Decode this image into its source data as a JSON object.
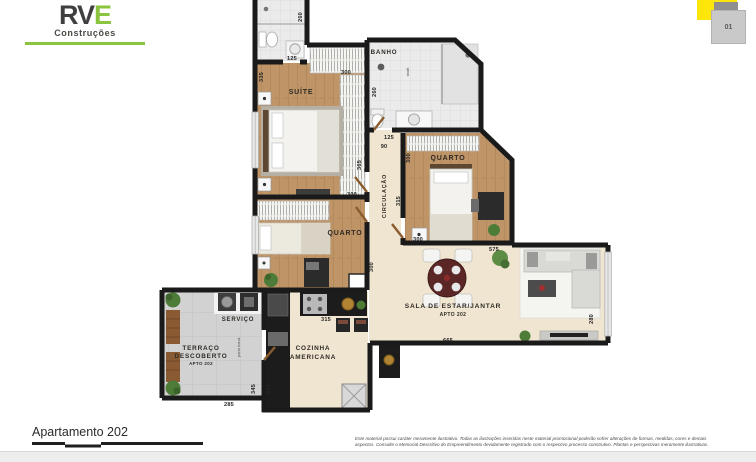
{
  "logo": {
    "brand_part1": "RV",
    "brand_part2": "E",
    "subtitle": "Construções"
  },
  "key_plan": {
    "unit_label": "01"
  },
  "rooms": {
    "banho": "BANHO",
    "suite": "SUÍTE",
    "quarto_right": "QUARTO",
    "quarto_left": "QUARTO",
    "circulacao": "CIRCULAÇÃO",
    "sala_line1": "SALA DE ESTAR/JANTAR",
    "sala_line2": "APTO 202",
    "cozinha_line1": "COZINHA",
    "cozinha_line2": "AMERICANA",
    "servico": "SERVIÇO",
    "terraco_line1": "TERRAÇO",
    "terraco_line2": "DESCOBERTO",
    "terraco_line3": "APTO 202",
    "shaft_note": "shaft",
    "door_note": "porta band."
  },
  "measurements": {
    "bath1_h": "260",
    "bath1_w": "125",
    "suite_left": "335",
    "suite_w": "300",
    "suite_total_h": "365",
    "banho_h": "260",
    "banho_w": "125",
    "hall_w": "90",
    "quarto_r_h": "300",
    "circ_h": "315",
    "quarto_r_w": "300",
    "sala_top_w": "575",
    "quarto_l_w": "300",
    "quarto_l_h": "300",
    "cozinha_w": "315",
    "sala_w": "665",
    "sala_h": "280",
    "terraco_w": "285",
    "terraco_h": "345",
    "cozinha_h": "335"
  },
  "footer": {
    "plan_title": "Apartamento 202",
    "disclaimer_line1": "Este material possui caráter meramente ilustrativo. Todas as ilustrações inseridas neste material promocional poderão sofrer alterações de formas, medidas, cores e demais",
    "disclaimer_line2": "aspectos. Consulte o Memorial Descritivo do Empreendimento devidamente registrado com o respectivo processo construtivo. Plantas e perspectivas meramente ilustrativas."
  },
  "colors": {
    "brand_green": "#8bc53f",
    "key_plan_yellow": "#ffe60a"
  }
}
